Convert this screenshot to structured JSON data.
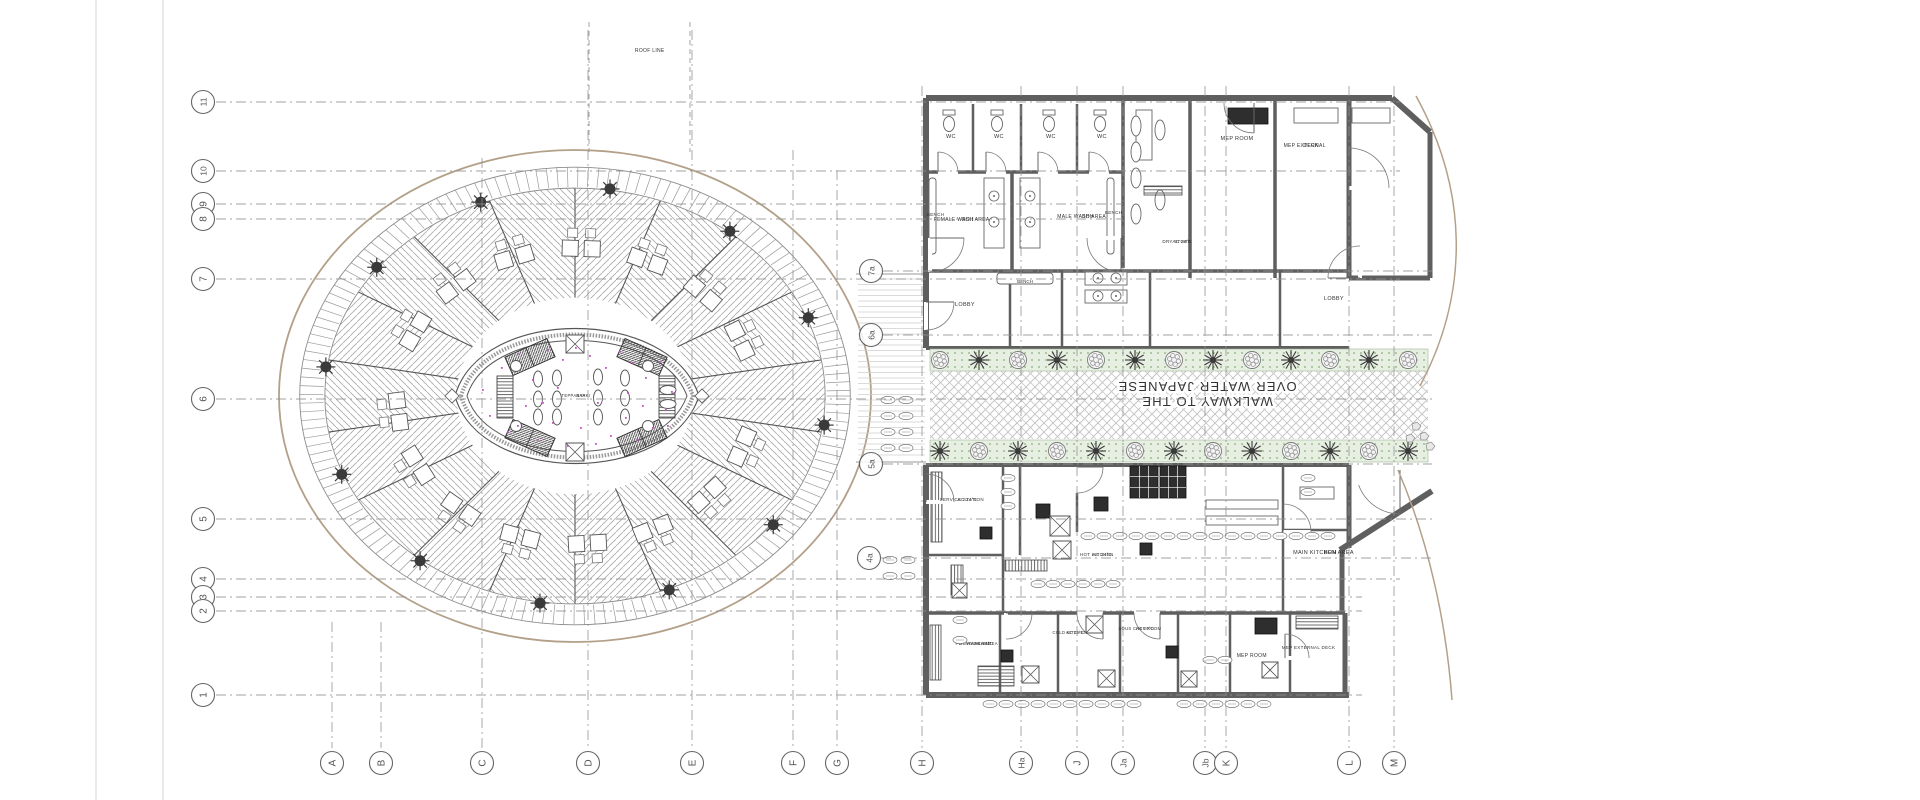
{
  "canvas": {
    "width": 1920,
    "height": 800,
    "background": "#ffffff"
  },
  "colors": {
    "wall": "#5f5f5f",
    "wallDark": "#3c3c3c",
    "line": "#6f6f6f",
    "lightLine": "#a8a8a8",
    "grid": "#8f8f8f",
    "roof": "#b3a089",
    "tree": "#3a3a3a",
    "greenBand": "#e7efe2",
    "greenDot": "#9dbd8f",
    "accent": "#c94fc9",
    "text": "#3f3f3f",
    "margin": "#d5d5d5"
  },
  "grid": {
    "row_bubble_x": 203,
    "row_line_x1": 216,
    "rows": [
      {
        "label": "11",
        "y": 102,
        "x2": 1400
      },
      {
        "label": "10",
        "y": 171,
        "x2": 1400
      },
      {
        "label": "9",
        "y": 204,
        "x2": 1123
      },
      {
        "label": "8",
        "y": 219,
        "x2": 1123
      },
      {
        "label": "7",
        "y": 279,
        "x2": 1400
      },
      {
        "label": "6",
        "y": 399,
        "x2": 1432
      },
      {
        "label": "5",
        "y": 519,
        "x2": 1432
      },
      {
        "label": "4",
        "y": 579,
        "x2": 1400
      },
      {
        "label": "3",
        "y": 597,
        "x2": 1362
      },
      {
        "label": "2",
        "y": 611,
        "x2": 1362
      },
      {
        "label": "1",
        "y": 695,
        "x2": 1362
      }
    ],
    "col_bubble_y": 763,
    "col_line_y2": 748,
    "cols": [
      {
        "label": "A",
        "x": 332,
        "y1": 622
      },
      {
        "label": "B",
        "x": 381,
        "y1": 622
      },
      {
        "label": "C",
        "x": 482,
        "y1": 158
      },
      {
        "label": "D",
        "x": 588,
        "y1": 30
      },
      {
        "label": "E",
        "x": 692,
        "y1": 30
      },
      {
        "label": "F",
        "x": 793,
        "y1": 150
      },
      {
        "label": "G",
        "x": 837,
        "y1": 170
      },
      {
        "label": "H",
        "x": 922,
        "y1": 86
      },
      {
        "label": "Ha",
        "x": 1021,
        "y1": 86
      },
      {
        "label": "J",
        "x": 1077,
        "y1": 86
      },
      {
        "label": "Ja",
        "x": 1123,
        "y1": 86
      },
      {
        "label": "Jb",
        "x": 1205,
        "y1": 86
      },
      {
        "label": "K",
        "x": 1226,
        "y1": 86
      },
      {
        "label": "L",
        "x": 1349,
        "y1": 86
      },
      {
        "label": "M",
        "x": 1394,
        "y1": 86
      }
    ],
    "intermediate": [
      {
        "label": "7a",
        "x": 871,
        "y": 271
      },
      {
        "label": "6a",
        "x": 871,
        "y": 335
      },
      {
        "label": "5a",
        "x": 871,
        "y": 464
      },
      {
        "label": "4a",
        "x": 869,
        "y": 558
      }
    ]
  },
  "annotations": {
    "roof_line": {
      "text": "ROOF LINE",
      "x": 648,
      "y": 52
    },
    "walkway": {
      "lines": [
        "WALKWAY TO THE",
        "OVER WATER JAPANESE"
      ],
      "cx": 1207,
      "cy": 389,
      "size": 13
    },
    "pavilion_label": {
      "lines": [
        "TEPPANYAKI",
        "BAR"
      ],
      "x": 577,
      "y": 397,
      "size": 4.2
    }
  },
  "rooms": [
    {
      "id": "wc-1",
      "lines": [
        "WC"
      ],
      "x": 949,
      "y": 138,
      "rot": -90,
      "s": 5.5
    },
    {
      "id": "wc-2",
      "lines": [
        "WC"
      ],
      "x": 997,
      "y": 138,
      "rot": -90,
      "s": 5.5
    },
    {
      "id": "wc-3",
      "lines": [
        "WC"
      ],
      "x": 1049,
      "y": 138,
      "rot": -90,
      "s": 5.5
    },
    {
      "id": "wc-4",
      "lines": [
        "WC"
      ],
      "x": 1100,
      "y": 138,
      "rot": -90,
      "s": 5.5
    },
    {
      "id": "female-wash-area",
      "lines": [
        "FEMALE WASH AREA",
        "BOH"
      ],
      "x": 963,
      "y": 221,
      "rot": -90,
      "s": 5
    },
    {
      "id": "male-wash-area",
      "lines": [
        "MALE WASH AREA",
        "BOH"
      ],
      "x": 1083,
      "y": 218,
      "rot": -90,
      "s": 5
    },
    {
      "id": "bench-left",
      "lines": [
        "BENCH"
      ],
      "x": 934,
      "y": 216,
      "rot": -90,
      "s": 4.5
    },
    {
      "id": "bench-right",
      "lines": [
        "BENCH"
      ],
      "x": 1112,
      "y": 214,
      "rot": -90,
      "s": 4.5
    },
    {
      "id": "bench-mid",
      "lines": [
        "BENCH"
      ],
      "x": 1025,
      "y": 283,
      "rot": 0,
      "s": 4.5
    },
    {
      "id": "lobby-left",
      "lines": [
        "LOBBY"
      ],
      "x": 963,
      "y": 306,
      "rot": -90,
      "s": 5.5
    },
    {
      "id": "lobby-right",
      "lines": [
        "LOBBY"
      ],
      "x": 1332,
      "y": 300,
      "rot": -90,
      "s": 5.5
    },
    {
      "id": "dry-store",
      "lines": [
        "DRY STORE",
        "AC 24°C"
      ],
      "x": 1178,
      "y": 243,
      "rot": -90,
      "s": 4.5
    },
    {
      "id": "mep-room-top",
      "lines": [
        "MEP ROOM"
      ],
      "x": 1235,
      "y": 140,
      "rot": -90,
      "s": 5.5
    },
    {
      "id": "mep-external-deck-top",
      "lines": [
        "MEP EXTERNAL",
        "DECK"
      ],
      "x": 1306,
      "y": 147,
      "rot": -90,
      "s": 5
    },
    {
      "id": "service-station",
      "lines": [
        "SERVICE STATION",
        "AC 24°C"
      ],
      "x": 963,
      "y": 501,
      "rot": -90,
      "s": 4.5
    },
    {
      "id": "hot-kitchen",
      "lines": [
        "HOT KITCHEN",
        "AC 24°C"
      ],
      "x": 1098,
      "y": 556,
      "rot": -90,
      "s": 4.5
    },
    {
      "id": "main-kitchen-area",
      "lines": [
        "MAIN KITCHEN AREA",
        "BOH"
      ],
      "x": 1325,
      "y": 554,
      "rot": -90,
      "s": 5.5
    },
    {
      "id": "pot-wash",
      "lines": [
        "POT WASH AND",
        "DISHWASH AREA",
        "AC 24°C"
      ],
      "x": 977,
      "y": 645,
      "rot": -90,
      "s": 4.2
    },
    {
      "id": "cold-kitchen",
      "lines": [
        "COLD KITCHEN",
        "AC 24°C"
      ],
      "x": 1071,
      "y": 634,
      "rot": -90,
      "s": 4.2
    },
    {
      "id": "sous-chef-room",
      "lines": [
        "SOUS CHEF ROOM",
        "AC 20°C"
      ],
      "x": 1141,
      "y": 630,
      "rot": -90,
      "s": 4.2
    },
    {
      "id": "mep-room-bottom",
      "lines": [
        "MEP ROOM"
      ],
      "x": 1250,
      "y": 657,
      "rot": -90,
      "s": 5
    },
    {
      "id": "mep-external-deck-bottom",
      "lines": [
        "MEP EXTERNAL DECK"
      ],
      "x": 1307,
      "y": 649,
      "rot": -90,
      "s": 4.5
    }
  ],
  "pavilion": {
    "cx": 575,
    "cy": 396,
    "rx": 296,
    "ry": 246
  }
}
